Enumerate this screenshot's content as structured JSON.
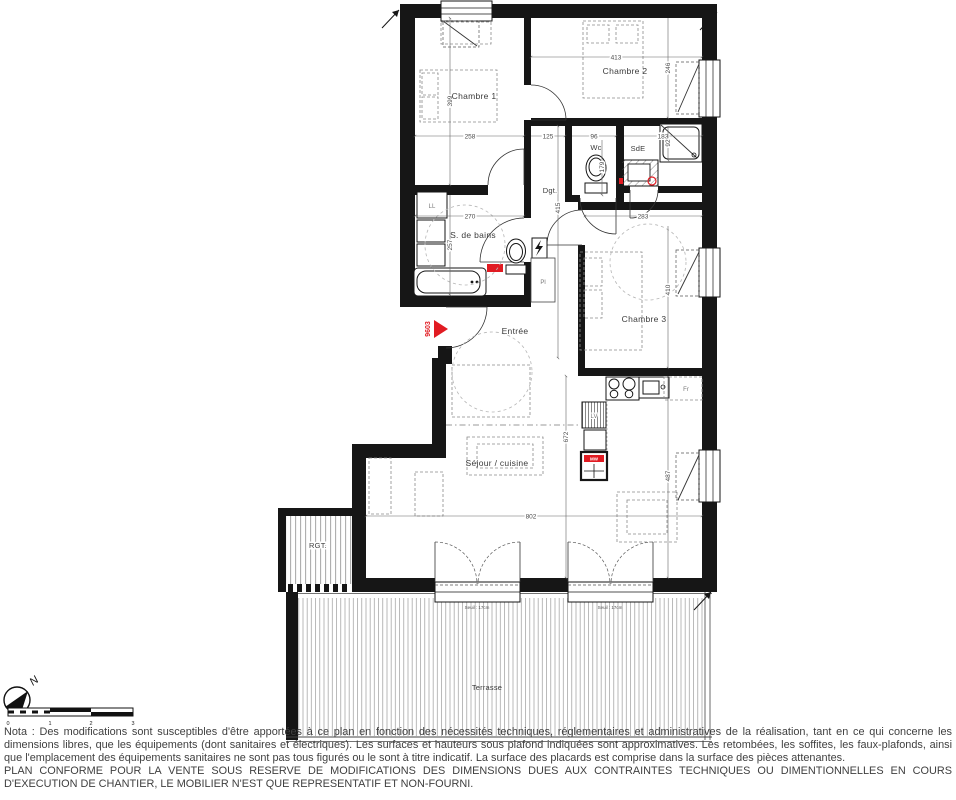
{
  "plan": {
    "rooms": {
      "chambre1": "Chambre 1",
      "chambre2": "Chambre 2",
      "chambre3": "Chambre 3",
      "wc": "Wc",
      "sde": "SdE",
      "sdb": "S. de bains",
      "dgt": "Dgt.",
      "pl": "Pl",
      "entree": "Entrée",
      "sejour": "Séjour / cuisine",
      "rgt": "RGT.",
      "terrasse": "Terrasse"
    },
    "appliances": {
      "ll": "LL",
      "lv": "LV",
      "fr": "Fr",
      "mw": "MW"
    },
    "dims": {
      "d399": "399",
      "d258": "258",
      "d125": "125",
      "d96": "96",
      "d183": "183",
      "d92": "92",
      "d413": "413",
      "d246": "246",
      "d179": "179",
      "d415": "415",
      "d270": "270",
      "d257": "257",
      "d283": "283",
      "d410": "410",
      "d672": "672",
      "d802": "802",
      "d487": "487"
    },
    "lot": {
      "number": "9603"
    },
    "seuil": "Seuil : 17cm",
    "compass": {
      "north": "N"
    },
    "scale_bar": {
      "t0": "0",
      "t1": "1",
      "t2": "2",
      "t3": "3"
    }
  },
  "notes": {
    "nota": "Nota : Des modifications sont susceptibles d'être apportées à ce plan en fonction des nécessités techniques, réglementaires et administratives de la réalisation, tant en ce qui concerne les dimensions libres, que les équipements (dont sanitaires et électriques). Les surfaces et hauteurs sous plafond indiquées sont approximatives. Les retombées, les soffites, les faux-plafonds, ainsi que l'emplacement des équipements sanitaires ne sont pas tous figurés ou le sont à titre indicatif. La surface des placards est comprise dans la surface des pièces attenantes.",
    "conforme": "PLAN CONFORME POUR LA VENTE SOUS RESERVE DE MODIFICATIONS DES DIMENSIONS DUES AUX CONTRAINTES TECHNIQUES OU DIMENTIONNELLES EN COURS D'EXECUTION DE CHANTIER, LE MOBILIER N'EST QUE REPRESENTATIF ET NON-FOURNI."
  }
}
